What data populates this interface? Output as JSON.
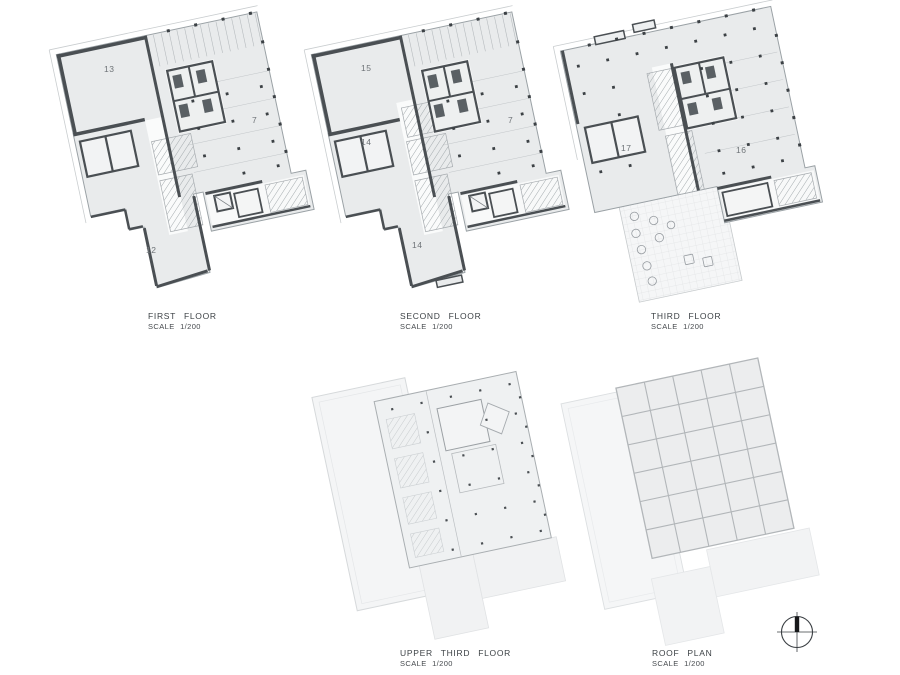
{
  "sheet": {
    "type": "architectural-drawing-sheet"
  },
  "colors": {
    "paper": "#ffffff",
    "floor_fill": "#e9ebec",
    "faint_fill": "#f3f4f5",
    "wall_dark": "#4a4f53",
    "line_mid": "#9aa1a5",
    "line_faint": "#cdd1d3",
    "label_text": "#3d4246",
    "room_text": "#6e7377"
  },
  "plans": [
    {
      "title": "FIRST FLOOR",
      "scale": "SCALE 1/200",
      "rooms": [
        {
          "label": "13"
        },
        {
          "label": "7"
        },
        {
          "label": "12"
        }
      ]
    },
    {
      "title": "SECOND FLOOR",
      "scale": "SCALE 1/200",
      "rooms": [
        {
          "label": "15"
        },
        {
          "label": "14"
        },
        {
          "label": "7"
        },
        {
          "label": "14"
        }
      ]
    },
    {
      "title": "THIRD FLOOR",
      "scale": "SCALE 1/200",
      "rooms": [
        {
          "label": "17"
        },
        {
          "label": "16"
        }
      ]
    },
    {
      "title": "UPPER THIRD FLOOR",
      "scale": "SCALE 1/200",
      "rooms": []
    },
    {
      "title": "ROOF PLAN",
      "scale": "SCALE 1/200",
      "rooms": []
    }
  ],
  "compass": {
    "icon": "north-arrow"
  }
}
